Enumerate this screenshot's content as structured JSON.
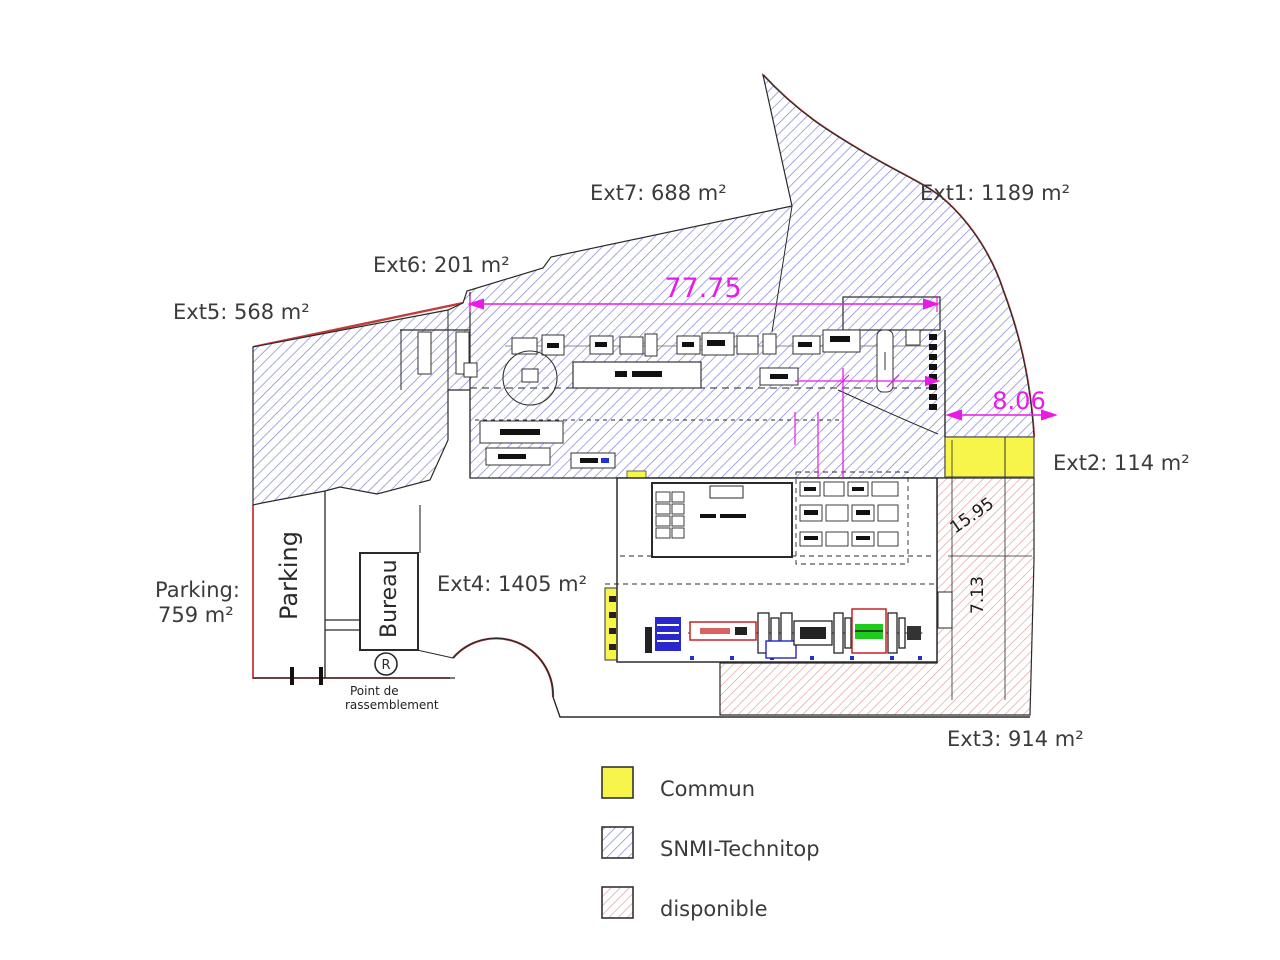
{
  "areas": {
    "ext1": "Ext1: 1189  m²",
    "ext2": "Ext2: 114  m²",
    "ext3": "Ext3: 914  m²",
    "ext4": "Ext4: 1405  m²",
    "ext5": "Ext5: 568  m²",
    "ext6": "Ext6: 201  m²",
    "ext7": "Ext7: 688  m²",
    "parking_label": "Parking:",
    "parking_value": "759 m²"
  },
  "rooms": {
    "parking": "Parking",
    "bureau": "Bureau"
  },
  "assembly_point": {
    "symbol": "R",
    "line1": "Point de",
    "line2": "rassemblement"
  },
  "dimensions": {
    "top_width": "77.75",
    "right_width": "8.06",
    "vert_a": "15.95",
    "vert_b": "7.13"
  },
  "legend": {
    "items": [
      {
        "label": "Commun",
        "swatch": "yellow-solid"
      },
      {
        "label": "SNMI-Technitop",
        "swatch": "blue-hatch"
      },
      {
        "label": "disponible",
        "swatch": "red-hatch"
      }
    ]
  },
  "colors": {
    "blue_hatch": "#8282d8",
    "red_hatch": "#e29494",
    "yellow": "#f7f54a",
    "magenta": "#e81ae8",
    "boundary_red": "#c23b3b",
    "outline": "#2a2a2a",
    "label_gray": "#3b3b3b"
  }
}
